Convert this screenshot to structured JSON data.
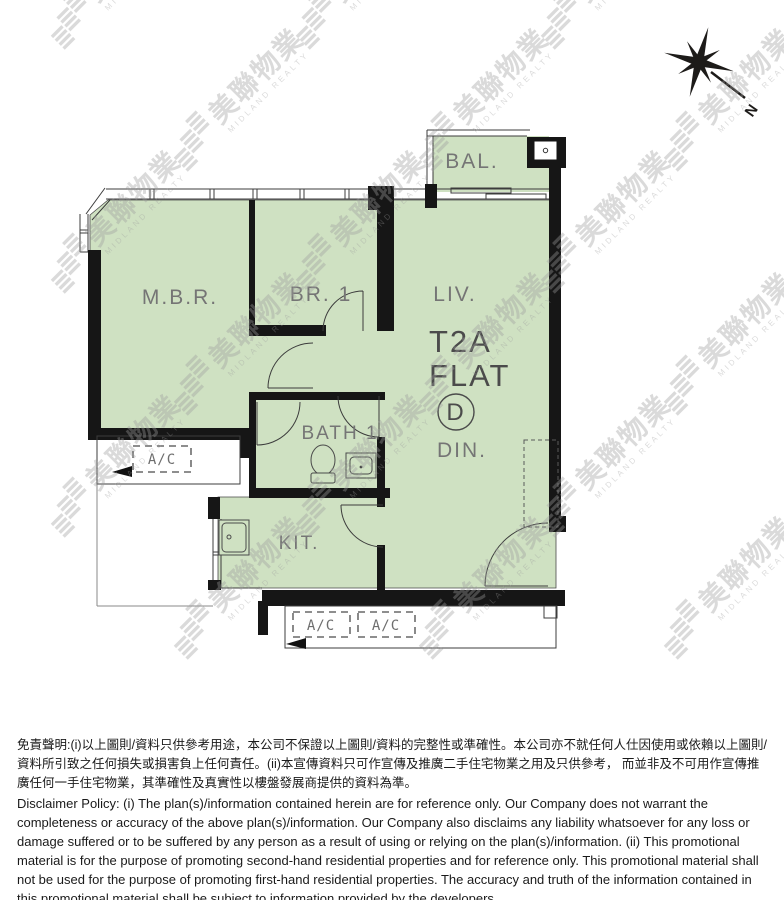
{
  "plan": {
    "rooms": {
      "mbr": "M.B.R.",
      "br1": "BR. 1",
      "liv": "LIV.",
      "din": "DIN.",
      "bal": "BAL.",
      "bath": "BATH 1",
      "kit": "KIT."
    },
    "unit": {
      "tower": "T2A",
      "flat_word": "FLAT",
      "flat_letter": "D"
    },
    "ac_label": "A/C",
    "compass_label": "N"
  },
  "watermark": {
    "cjk": "美聯物業",
    "latin": "MIDLAND REALTY"
  },
  "disclaimer": {
    "zh": "免責聲明:(i)以上圖則/資料只供參考用途，本公司不保證以上圖則/資料的完整性或準確性。本公司亦不就任何人仕因使用或依賴以上圖則/資料所引致之任何損失或損害負上任何責任。(ii)本宣傳資料只可作宣傳及推廣二手住宅物業之用及只供參考， 而並非及不可用作宣傳推廣任何一手住宅物業，其準確性及真實性以樓盤發展商提供的資料為準。",
    "en": "Disclaimer Policy: (i) The plan(s)/information contained herein are for reference only. Our Company does not warrant the completeness or accuracy of the above plan(s)/information. Our Company also disclaims any liability whatsoever for any loss or damage suffered or to be suffered by any person as a result of using or relying on the plan(s)/information. (ii) This promotional material is for the purpose of promoting second-hand residential properties and for reference only. This promotional material shall not be used for the purpose of promoting first-hand residential properties. The accuracy and truth of the information contained in this promotional material shall be subject to information provided by the developers."
  },
  "colors": {
    "plan_fill": "#cfe1c2",
    "wall": "#161616",
    "line": "#3c3c3c",
    "label": "#757575",
    "watermark": "#9e9e9e"
  }
}
